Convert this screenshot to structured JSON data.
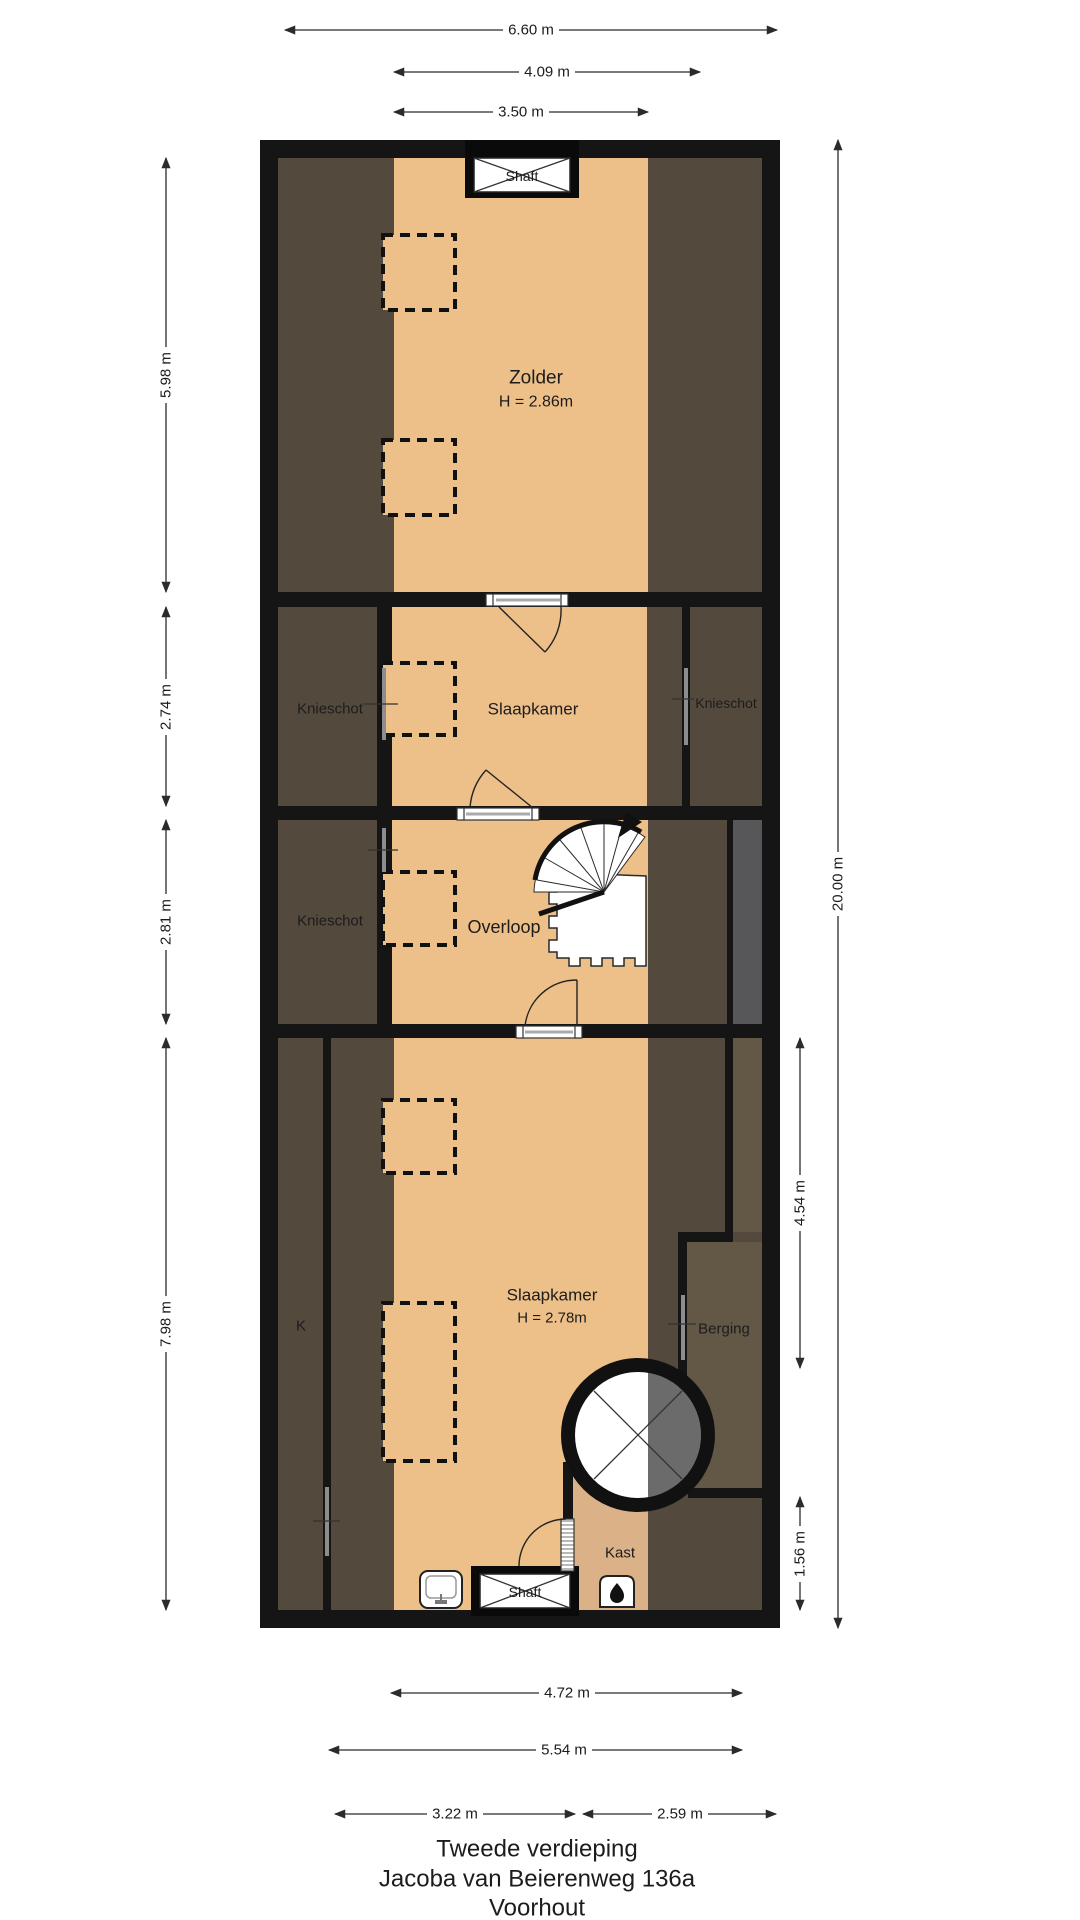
{
  "title": {
    "line1": "Tweede verdieping",
    "line2": "Jacoba van Beierenweg 136a",
    "line3": "Voorhout"
  },
  "rooms": {
    "zolder": {
      "name": "Zolder",
      "height": "H = 2.86m"
    },
    "slaapkamer_mid": {
      "name": "Slaapkamer"
    },
    "knieschot_mid_left": {
      "name": "Knieschot"
    },
    "knieschot_mid_right": {
      "name": "Knieschot"
    },
    "knieschot_overloop": {
      "name": "Knieschot"
    },
    "overloop": {
      "name": "Overloop"
    },
    "slaapkamer_bottom": {
      "name": "Slaapkamer",
      "height": "H = 2.78m"
    },
    "k": {
      "name": "K"
    },
    "berging": {
      "name": "Berging"
    },
    "kast": {
      "name": "Kast"
    },
    "shaft_top": {
      "name": "Shaft"
    },
    "shaft_bottom": {
      "name": "Shaft"
    }
  },
  "dims": {
    "top": [
      "6.60 m",
      "4.09 m",
      "3.50 m"
    ],
    "left": [
      "5.98 m",
      "2.74 m",
      "2.81 m",
      "7.98 m"
    ],
    "right": [
      "20.00 m",
      "4.54 m",
      "1.56 m"
    ],
    "bottom": [
      "4.72 m",
      "5.54 m",
      "3.22 m",
      "2.59 m"
    ]
  },
  "colors": {
    "floor_tan": "#edc089",
    "low_ceiling_shade": "#54493d",
    "berging_brown": "#635746",
    "kast_beige": "#dbb287",
    "wall_black": "#151515",
    "shaft_gray": "#57575a",
    "stair_void_gray": "#6b6b6b"
  }
}
